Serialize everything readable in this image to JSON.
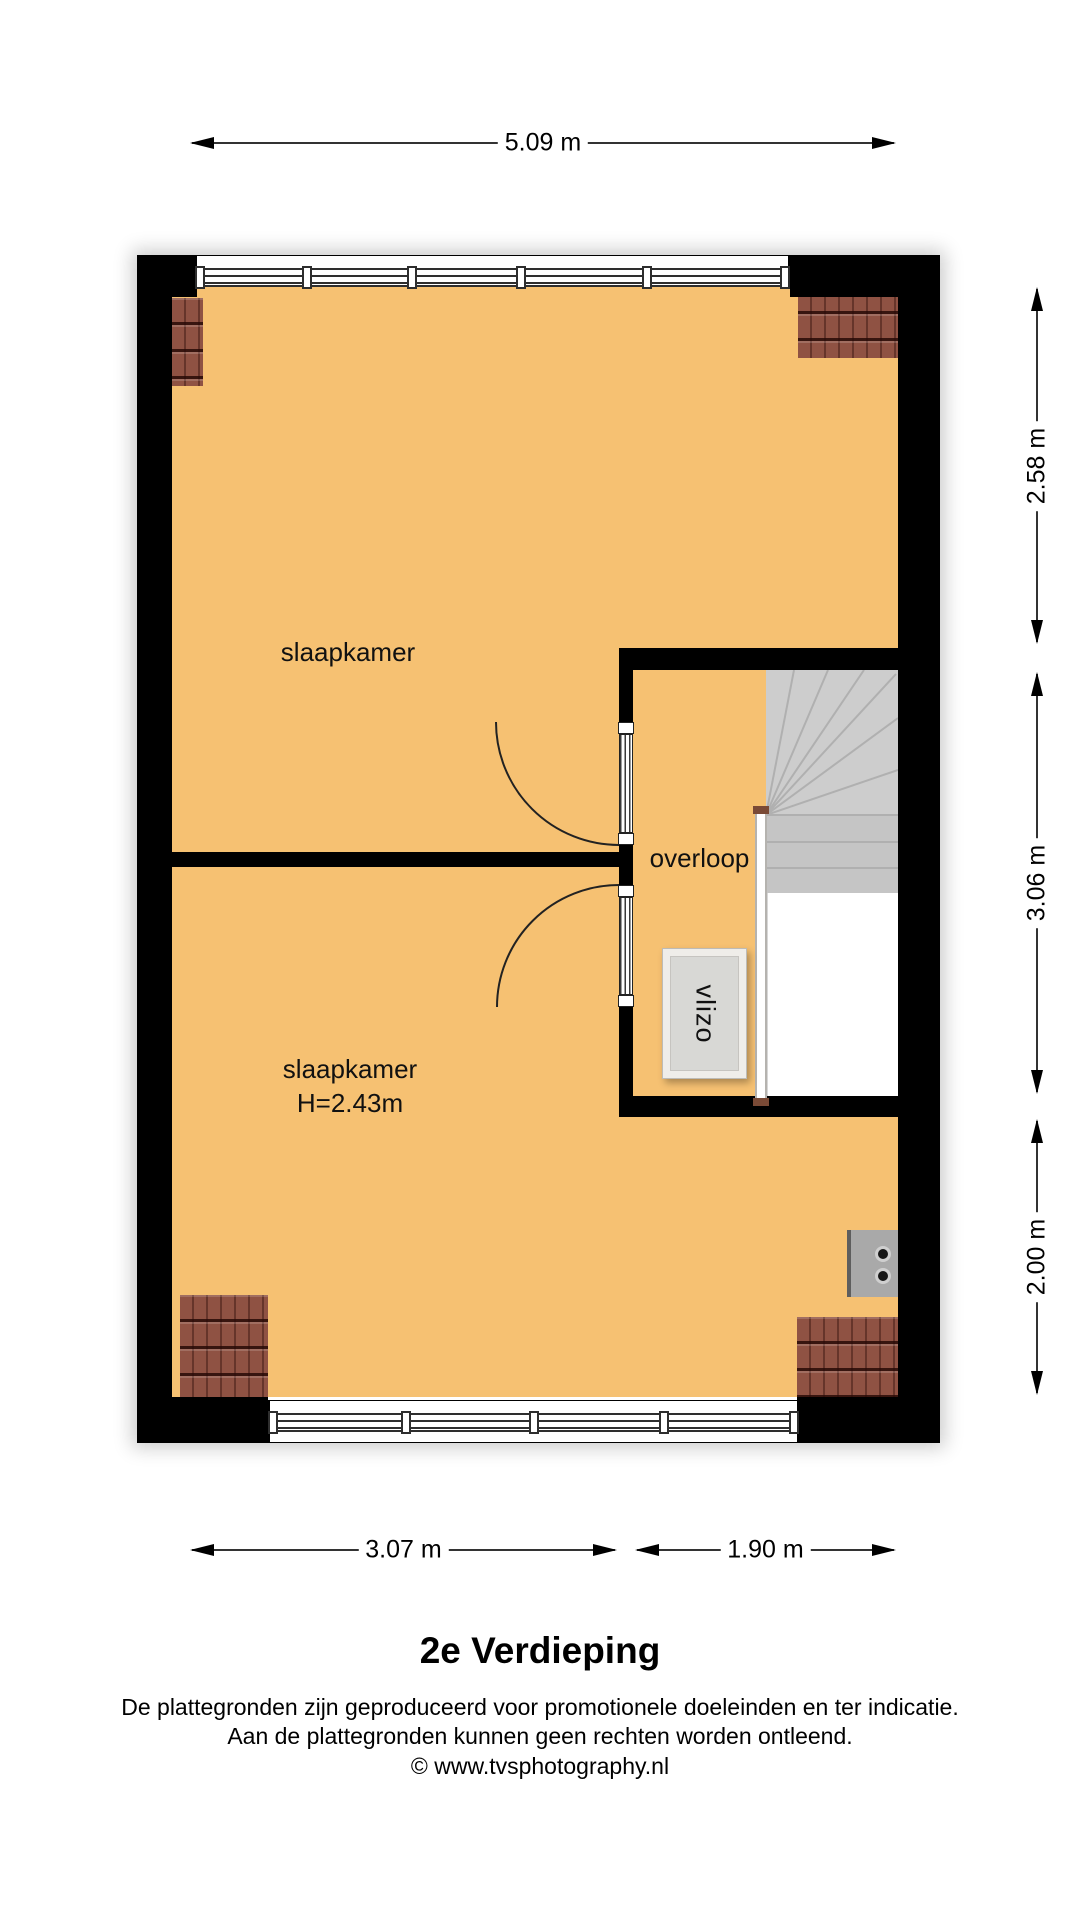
{
  "plan": {
    "colors": {
      "floor": "#f6c172",
      "wall": "#000000",
      "stairs": "#cdcdcd",
      "roof_tiles": "#8f5243",
      "hatch": "#d8d8d5"
    },
    "rooms": {
      "bedroom_top": {
        "label": "slaapkamer"
      },
      "bedroom_bottom": {
        "label": "slaapkamer",
        "height_note": "H=2.43m"
      },
      "landing": {
        "label": "overloop"
      },
      "loft_hatch": {
        "label": "vlizo"
      }
    },
    "dims": {
      "top_width": "5.09 m",
      "right_top": "2.58 m",
      "right_middle": "3.06 m",
      "right_bottom": "2.00 m",
      "bottom_left": "3.07 m",
      "bottom_right": "1.90 m"
    }
  },
  "caption": {
    "title": "2e Verdieping",
    "disclaimer1": "De plattegronden zijn geproduceerd voor promotionele doeleinden en ter indicatie.",
    "disclaimer2": "Aan de plattegronden kunnen geen rechten worden ontleend.",
    "copyright": "© www.tvsphotography.nl"
  }
}
